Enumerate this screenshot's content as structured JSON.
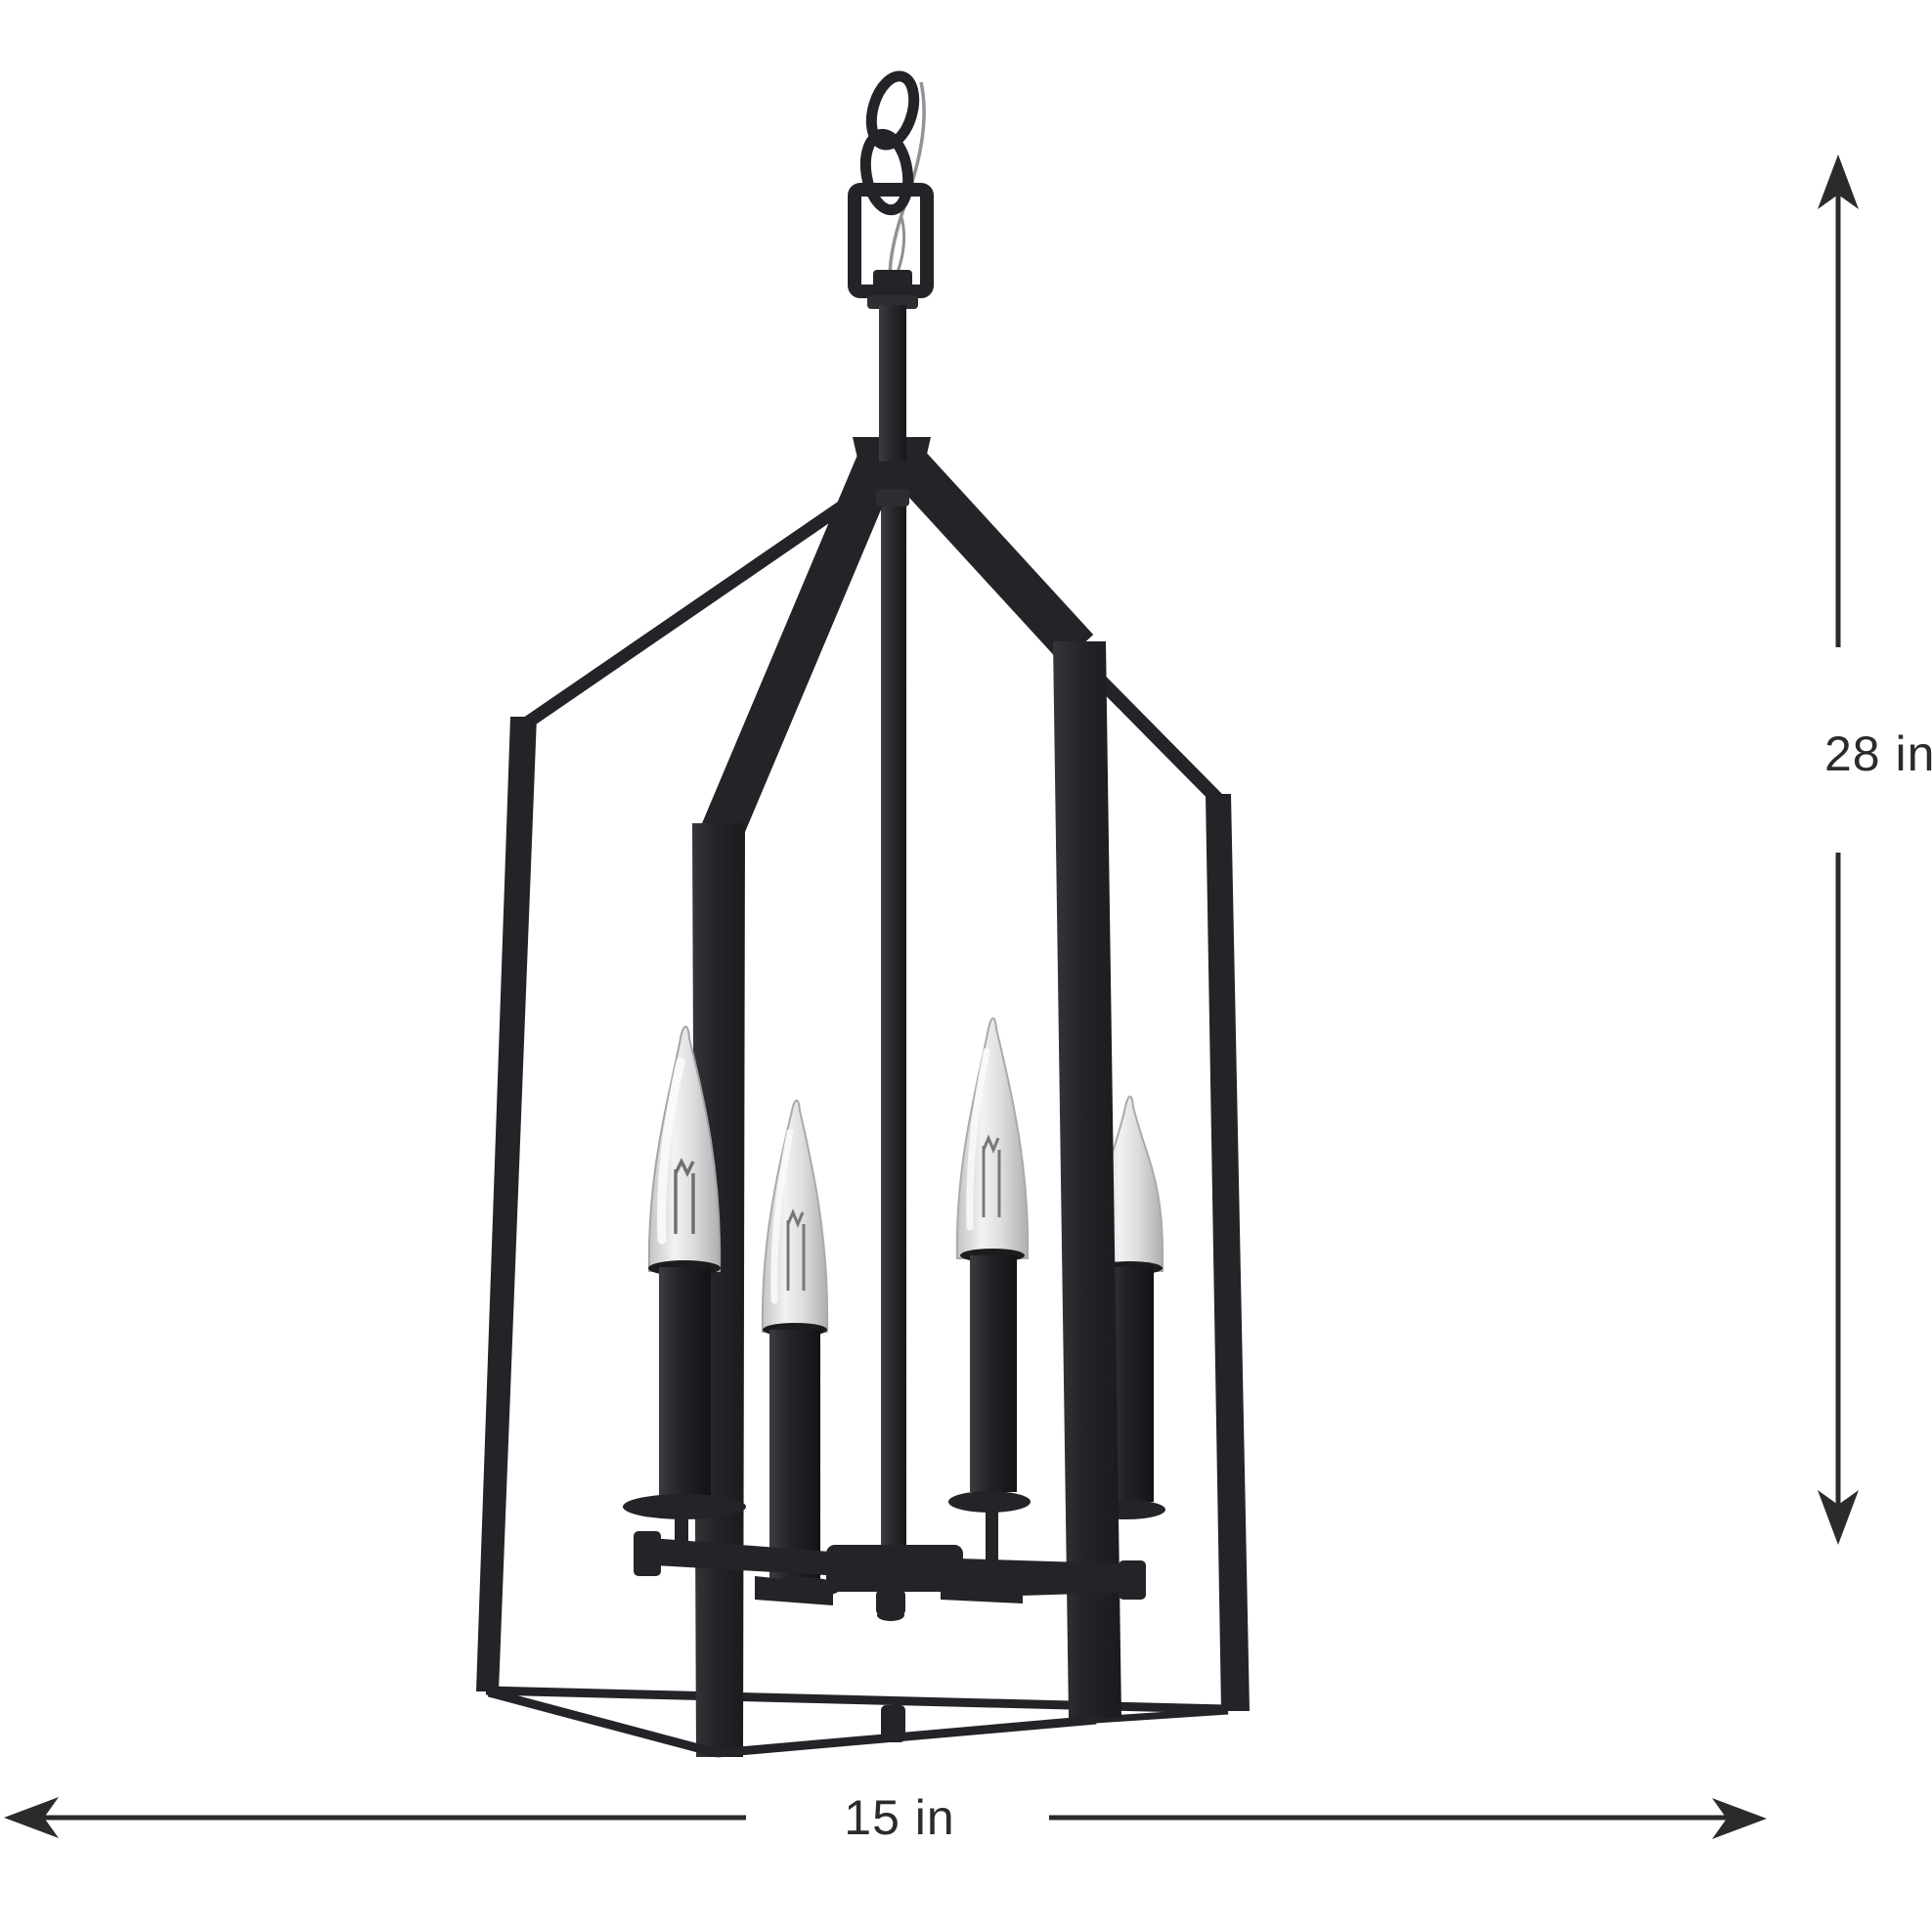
{
  "figure": {
    "background": "#ffffff",
    "subject": "Matte black four-light lantern foyer pendant chandelier with candelabra bulbs, shown as a product dimension diagram",
    "lights_count": 4,
    "colors": {
      "frame": "#232428",
      "frame_highlight": "#33353a",
      "bulb_glass": "#d9dadc",
      "bulb_glass_light": "#f4f4f4",
      "bulb_glass_shadow": "#b6b7b9",
      "dimension_line": "#2b2b2b",
      "chain_wire": "#909295"
    }
  },
  "dimensions": {
    "height_label": "28 in",
    "width_label": "15 in"
  }
}
